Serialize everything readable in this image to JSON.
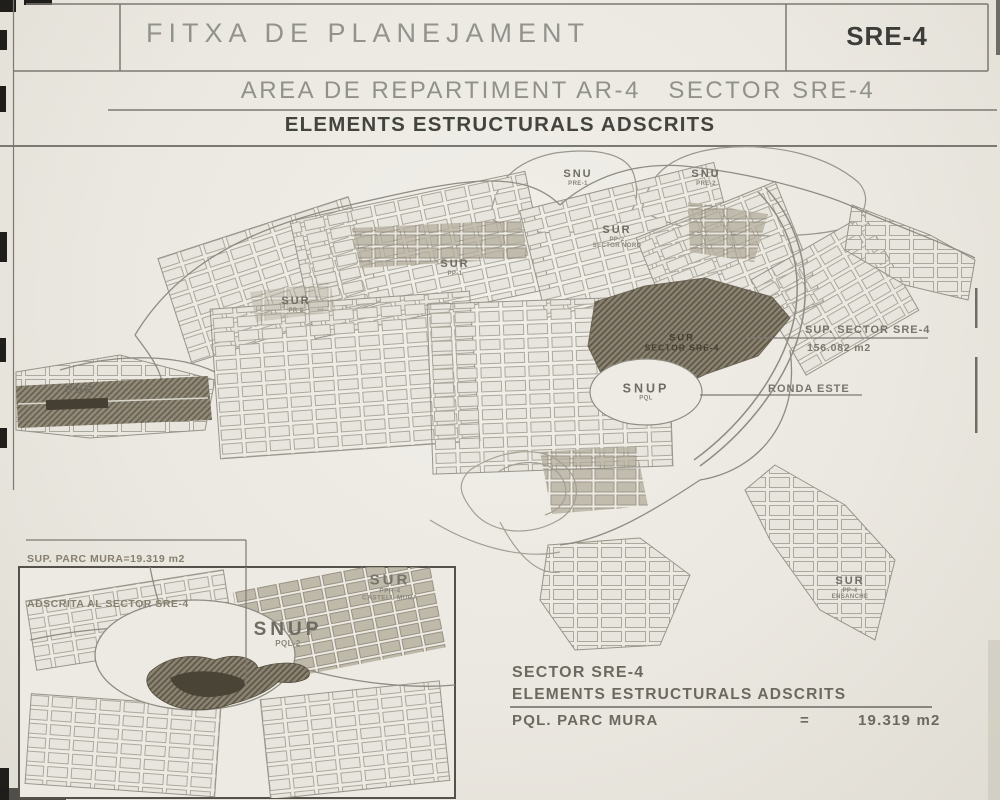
{
  "header": {
    "title": "FITXA DE PLANEJAMENT",
    "code": "SRE-4",
    "subtitle": "AREA DE REPARTIMENT AR-4   SECTOR SRE-4",
    "section_title": "ELEMENTS ESTRUCTURALS ADSCRITS"
  },
  "map": {
    "labels": [
      {
        "text": "SNU",
        "sub": "PRE-1"
      },
      {
        "text": "SNU",
        "sub": "PRE-2"
      },
      {
        "text": "SUR",
        "sub": "PP-2",
        "sub2": "SECTOR NORD"
      },
      {
        "text": "SUR",
        "sub": "PP-1"
      },
      {
        "text": "SUR",
        "sub": "PP-3"
      },
      {
        "text": "SUR"
      },
      {
        "text": "SUR",
        "sub": "SECTOR SRE-4"
      },
      {
        "text": "SNUP",
        "sub": "PQL"
      },
      {
        "text": "SUR",
        "sub": "PP-4",
        "sub2": "ENSANCHE"
      }
    ],
    "annotations": {
      "sup_title": "SUP. SECTOR SRE-4",
      "sup_value": "156.082 m2",
      "road": "RONDA ESTE"
    }
  },
  "inset": {
    "callout_line1": "SUP. PARC MURA=19.319 m2",
    "callout_line2": "ADSCRITA AL SECTOR SRE-4",
    "labels": [
      {
        "text": "SUR",
        "sub": "PPR-4",
        "sub2": "CASTELL MURA"
      },
      {
        "text": "SNUP",
        "sub": "PQL-2"
      }
    ]
  },
  "summary": {
    "sector": "SECTOR SRE-4",
    "subtitle": "ELEMENTS ESTRUCTURALS ADSCRITS",
    "item": "PQL. PARC MURA",
    "equals": "=",
    "value": "19.319 m2"
  },
  "colors": {
    "paper": "#ebe8e1",
    "ink_dark": "#3c3c38",
    "ink_gray": "#91918b",
    "map_line": "#918e85",
    "hatch_dark": "#6e675a"
  }
}
